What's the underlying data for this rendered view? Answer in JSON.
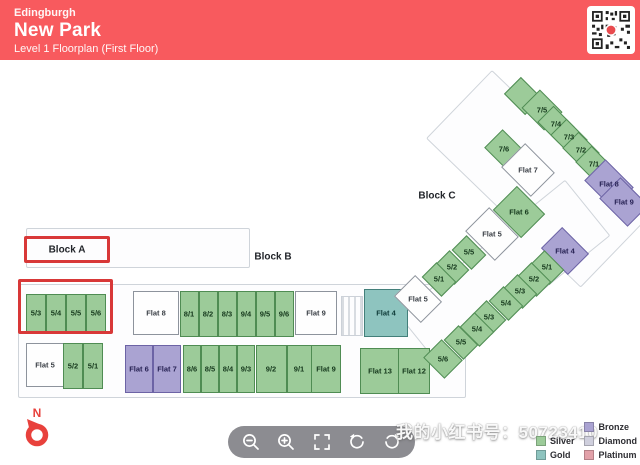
{
  "header": {
    "city": "Edingburgh",
    "title": "New Park",
    "subtitle": "Level 1 Floorplan (First Floor)",
    "bg_color": "#f85a5e"
  },
  "blocks": {
    "a": "Block A",
    "b": "Block B",
    "c": "Block C"
  },
  "floorplan": {
    "cells": [
      {
        "label": "5/3",
        "cx": 36,
        "cy": 313,
        "w": 20,
        "h": 38,
        "color": "g"
      },
      {
        "label": "5/4",
        "cx": 56,
        "cy": 313,
        "w": 20,
        "h": 38,
        "color": "g"
      },
      {
        "label": "5/5",
        "cx": 76,
        "cy": 313,
        "w": 20,
        "h": 38,
        "color": "g"
      },
      {
        "label": "5/6",
        "cx": 96,
        "cy": 313,
        "w": 20,
        "h": 38,
        "color": "g"
      },
      {
        "label": "Flat 5",
        "cx": 45,
        "cy": 365,
        "w": 38,
        "h": 44,
        "color": "w"
      },
      {
        "label": "5/2",
        "cx": 73,
        "cy": 366,
        "w": 20,
        "h": 46,
        "color": "g"
      },
      {
        "label": "5/1",
        "cx": 93,
        "cy": 366,
        "w": 20,
        "h": 46,
        "color": "g"
      },
      {
        "label": "Flat 8",
        "cx": 156,
        "cy": 313,
        "w": 46,
        "h": 44,
        "color": "w"
      },
      {
        "label": "8/1",
        "cx": 189,
        "cy": 314,
        "w": 19,
        "h": 46,
        "color": "g"
      },
      {
        "label": "8/2",
        "cx": 208,
        "cy": 314,
        "w": 19,
        "h": 46,
        "color": "g"
      },
      {
        "label": "8/3",
        "cx": 227,
        "cy": 314,
        "w": 19,
        "h": 46,
        "color": "g"
      },
      {
        "label": "9/4",
        "cx": 246,
        "cy": 314,
        "w": 19,
        "h": 46,
        "color": "g"
      },
      {
        "label": "9/5",
        "cx": 265,
        "cy": 314,
        "w": 19,
        "h": 46,
        "color": "g"
      },
      {
        "label": "9/6",
        "cx": 284,
        "cy": 314,
        "w": 19,
        "h": 46,
        "color": "g"
      },
      {
        "label": "Flat 9",
        "cx": 316,
        "cy": 313,
        "w": 42,
        "h": 44,
        "color": "w"
      },
      {
        "label": "Flat 4",
        "cx": 386,
        "cy": 313,
        "w": 44,
        "h": 48,
        "color": "t"
      },
      {
        "label": "Flat 6",
        "cx": 139,
        "cy": 369,
        "w": 28,
        "h": 48,
        "color": "p"
      },
      {
        "label": "Flat 7",
        "cx": 167,
        "cy": 369,
        "w": 28,
        "h": 48,
        "color": "p"
      },
      {
        "label": "8/6",
        "cx": 192,
        "cy": 369,
        "w": 18,
        "h": 48,
        "color": "g"
      },
      {
        "label": "8/5",
        "cx": 210,
        "cy": 369,
        "w": 18,
        "h": 48,
        "color": "g"
      },
      {
        "label": "8/4",
        "cx": 228,
        "cy": 369,
        "w": 18,
        "h": 48,
        "color": "g"
      },
      {
        "label": "9/3",
        "cx": 246,
        "cy": 369,
        "w": 18,
        "h": 48,
        "color": "g"
      },
      {
        "label": "9/2",
        "cx": 271,
        "cy": 369,
        "w": 31,
        "h": 48,
        "color": "g"
      },
      {
        "label": "9/1",
        "cx": 299,
        "cy": 369,
        "w": 25,
        "h": 48,
        "color": "g"
      },
      {
        "label": "Flat 9",
        "cx": 326,
        "cy": 369,
        "w": 30,
        "h": 48,
        "color": "g"
      },
      {
        "label": "Flat 13",
        "cx": 380,
        "cy": 371,
        "w": 40,
        "h": 46,
        "color": "g"
      },
      {
        "label": "Flat 12",
        "cx": 414,
        "cy": 371,
        "w": 32,
        "h": 46,
        "color": "g"
      },
      {
        "label": "",
        "cx": 523,
        "cy": 96,
        "w": 30,
        "h": 24,
        "color": "g",
        "rot": 45
      },
      {
        "label": "7/5",
        "cx": 542,
        "cy": 110,
        "w": 32,
        "h": 26,
        "color": "g",
        "rot": 45
      },
      {
        "label": "7/4",
        "cx": 556,
        "cy": 124,
        "w": 30,
        "h": 23,
        "color": "g",
        "rot": 45
      },
      {
        "label": "7/3",
        "cx": 569,
        "cy": 137,
        "w": 30,
        "h": 23,
        "color": "g",
        "rot": 45
      },
      {
        "label": "7/2",
        "cx": 581,
        "cy": 150,
        "w": 30,
        "h": 23,
        "color": "g",
        "rot": 45
      },
      {
        "label": "7/1",
        "cx": 594,
        "cy": 164,
        "w": 30,
        "h": 23,
        "color": "g",
        "rot": 45
      },
      {
        "label": "7/6",
        "cx": 504,
        "cy": 149,
        "w": 30,
        "h": 26,
        "color": "g",
        "rot": 45
      },
      {
        "label": "Flat 7",
        "cx": 528,
        "cy": 170,
        "w": 42,
        "h": 34,
        "color": "w",
        "rot": 45
      },
      {
        "label": "Flat 8",
        "cx": 609,
        "cy": 184,
        "w": 40,
        "h": 30,
        "color": "p",
        "rot": 45
      },
      {
        "label": "Flat 9",
        "cx": 624,
        "cy": 202,
        "w": 40,
        "h": 30,
        "color": "p",
        "rot": 45
      },
      {
        "label": "Flat 6",
        "cx": 519,
        "cy": 212,
        "w": 40,
        "h": 34,
        "color": "g",
        "rot": 45
      },
      {
        "label": "Flat 5",
        "cx": 492,
        "cy": 234,
        "w": 42,
        "h": 34,
        "color": "w",
        "rot": 45
      },
      {
        "label": "5/5",
        "cx": 469,
        "cy": 252,
        "w": 28,
        "h": 21,
        "color": "g",
        "rot": 45
      },
      {
        "label": "5/2",
        "cx": 452,
        "cy": 267,
        "w": 28,
        "h": 21,
        "color": "g",
        "rot": 45
      },
      {
        "label": "5/1",
        "cx": 439,
        "cy": 279,
        "w": 28,
        "h": 21,
        "color": "g",
        "rot": 45
      },
      {
        "label": "Flat 5",
        "cx": 418,
        "cy": 299,
        "w": 38,
        "h": 30,
        "color": "w",
        "rot": 45
      },
      {
        "label": "Flat 4",
        "cx": 565,
        "cy": 251,
        "w": 38,
        "h": 30,
        "color": "p",
        "rot": 45
      },
      {
        "label": "5/1",
        "cx": 547,
        "cy": 267,
        "w": 28,
        "h": 21,
        "color": "g",
        "rot": 45
      },
      {
        "label": "5/2",
        "cx": 534,
        "cy": 279,
        "w": 28,
        "h": 21,
        "color": "g",
        "rot": 45
      },
      {
        "label": "5/3",
        "cx": 520,
        "cy": 291,
        "w": 28,
        "h": 21,
        "color": "g",
        "rot": 45
      },
      {
        "label": "5/4",
        "cx": 506,
        "cy": 303,
        "w": 28,
        "h": 21,
        "color": "g",
        "rot": 45
      },
      {
        "label": "5/3",
        "cx": 489,
        "cy": 317,
        "w": 28,
        "h": 21,
        "color": "g",
        "rot": 45
      },
      {
        "label": "5/4",
        "cx": 477,
        "cy": 329,
        "w": 28,
        "h": 21,
        "color": "g",
        "rot": 45
      },
      {
        "label": "5/5",
        "cx": 461,
        "cy": 342,
        "w": 28,
        "h": 21,
        "color": "g",
        "rot": 45
      },
      {
        "label": "5/6",
        "cx": 443,
        "cy": 359,
        "w": 30,
        "h": 26,
        "color": "g",
        "rot": 45
      }
    ]
  },
  "legend": {
    "items": [
      {
        "label": "Silver",
        "color": "#9ccb99",
        "col": 1
      },
      {
        "label": "Gold",
        "color": "#8ec4bf",
        "col": 1
      },
      {
        "label": "Bronze",
        "color": "#aaa3d2",
        "col": 2
      },
      {
        "label": "Diamond",
        "color": "#cfcfdd",
        "col": 2
      },
      {
        "label": "Platinum",
        "color": "#e2a1a9",
        "col": 2
      }
    ]
  },
  "toolbar": {
    "buttons": [
      "zoom-out",
      "zoom-in",
      "fullscreen",
      "rotate-ccw",
      "rotate-cw"
    ]
  },
  "compass": {
    "label": "N"
  },
  "watermark": {
    "text": "我的小红书号：50723410"
  },
  "colors": {
    "header": "#f85a5e",
    "silver_green": "#9ccb99",
    "gold_teal": "#8ec4bf",
    "bronze_purple": "#aaa3d2",
    "highlight_red": "#d83838"
  }
}
